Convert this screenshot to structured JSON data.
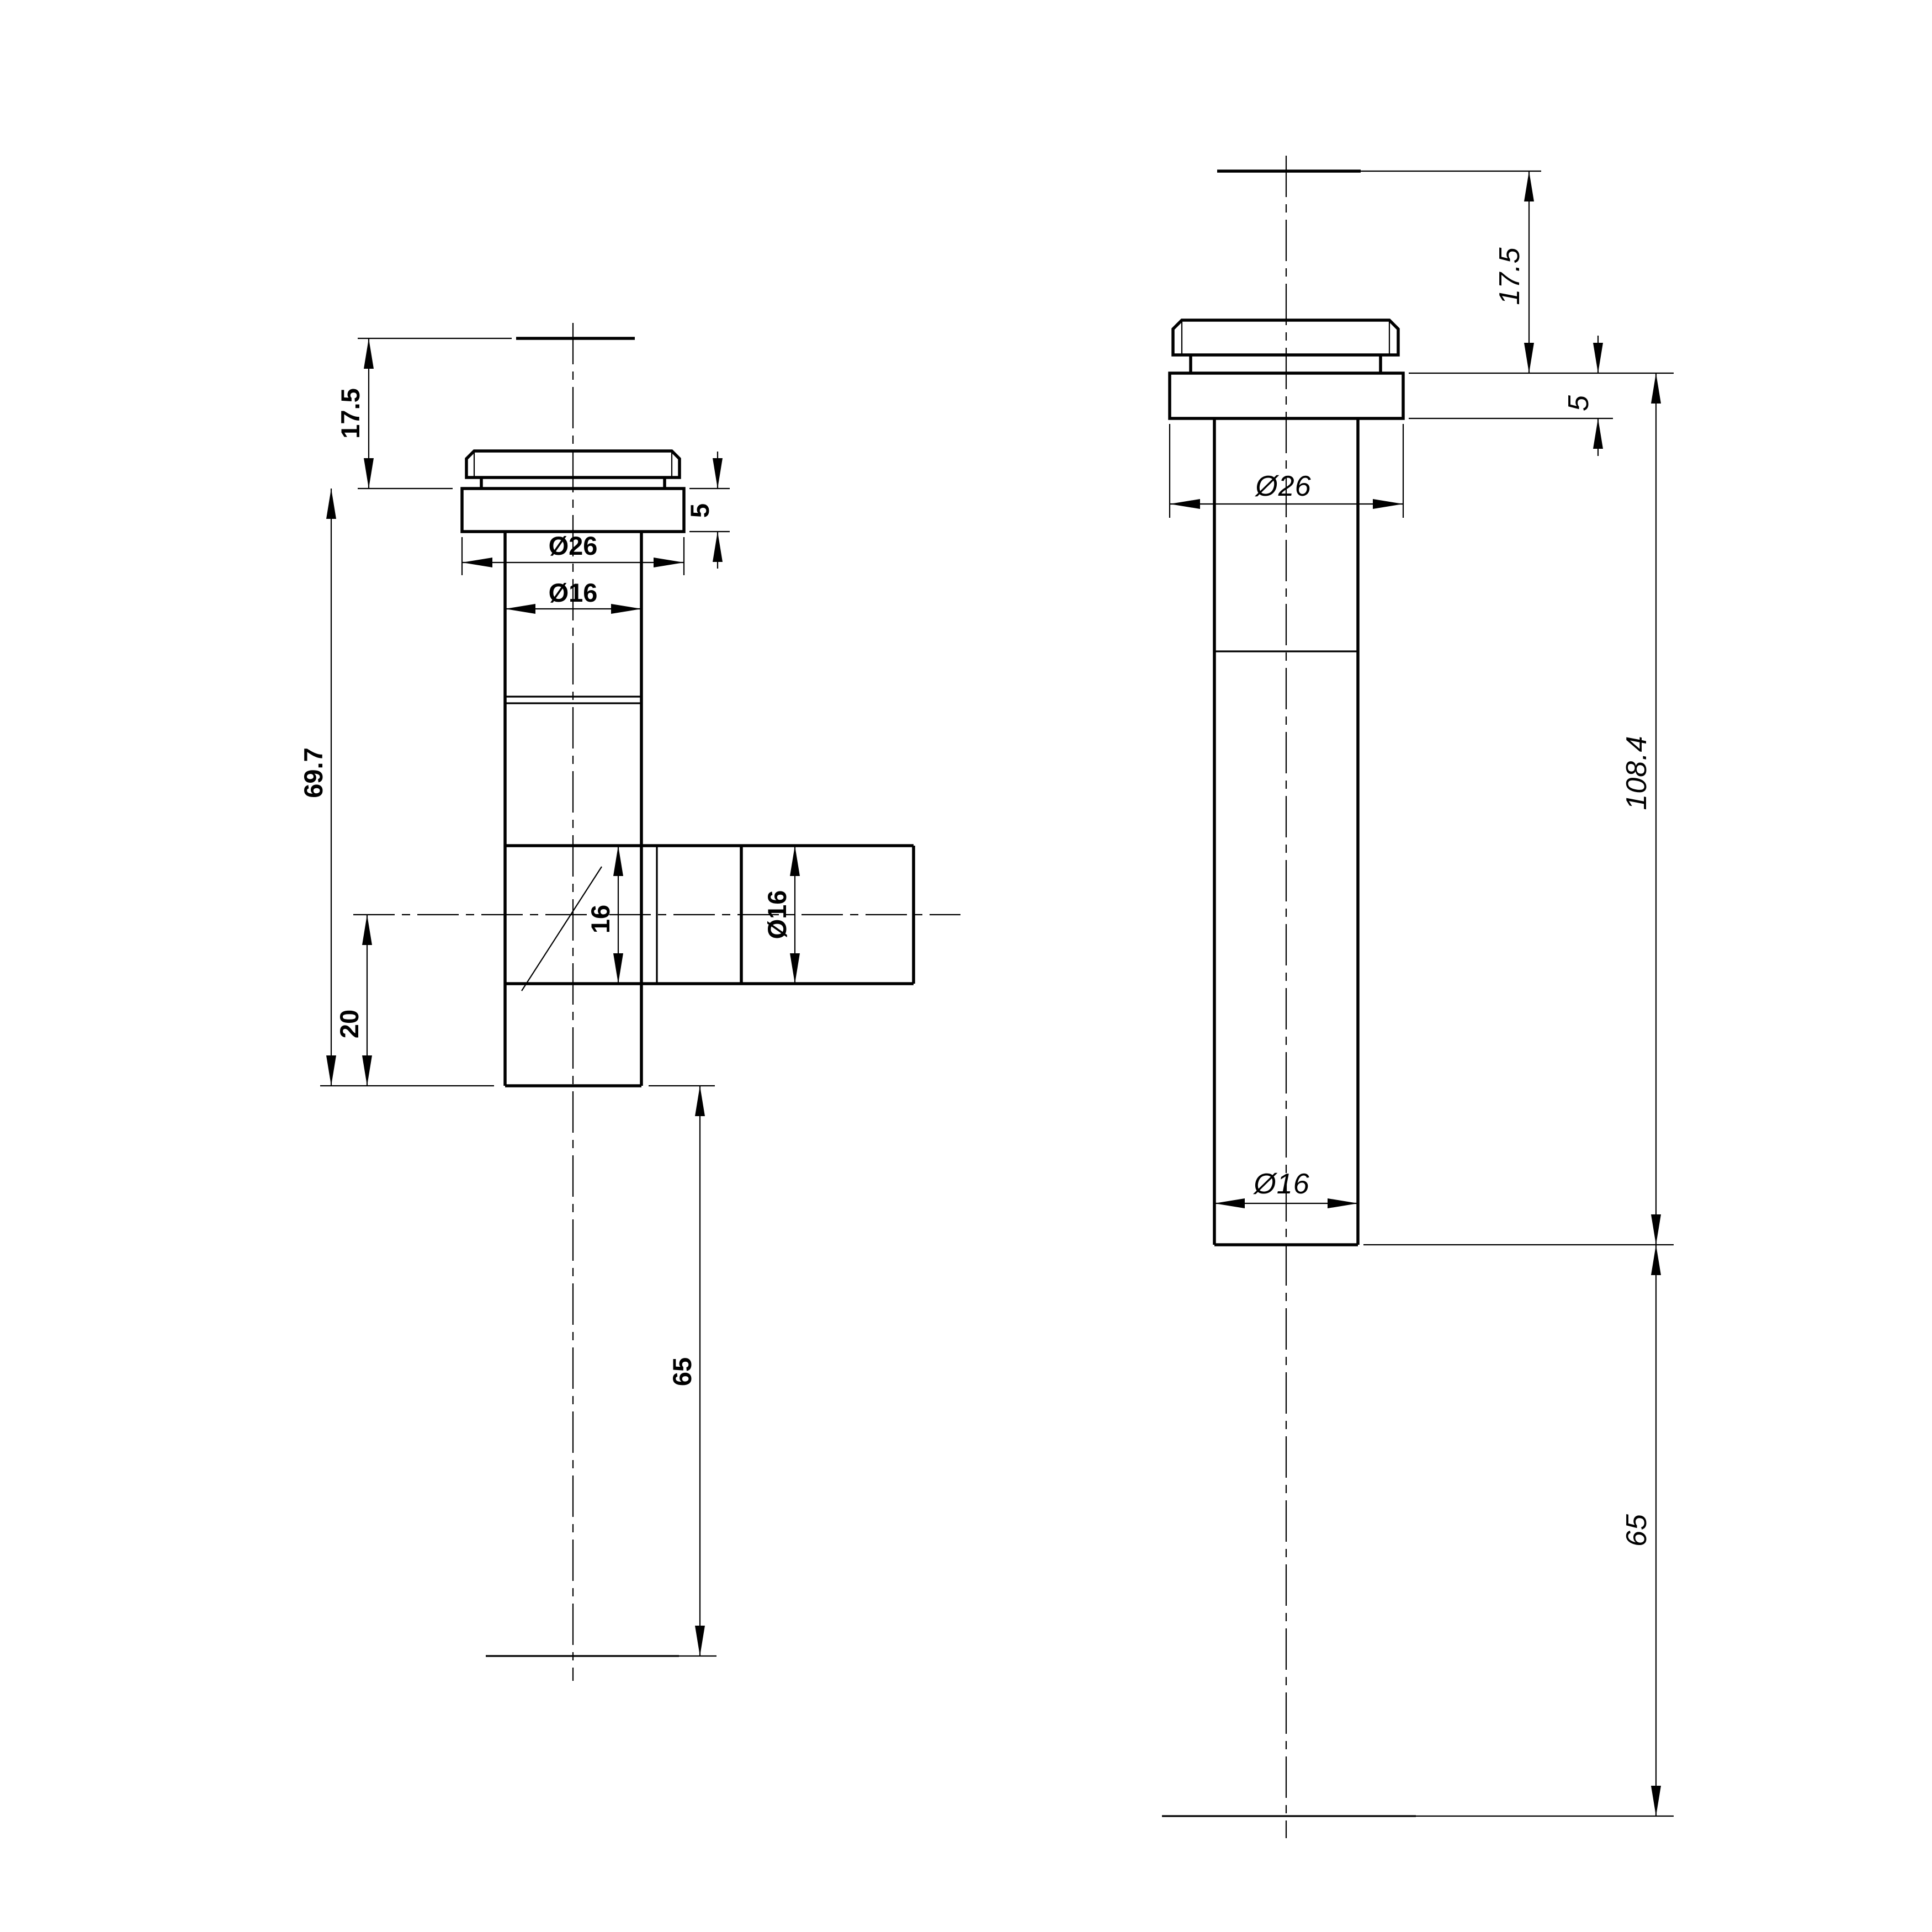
{
  "drawing": {
    "type": "cad-dimension-drawing",
    "background": "#ffffff",
    "ink": "#000000",
    "views": [
      {
        "name": "tee-fitting-side-view",
        "dims": {
          "cap_height": "17.5",
          "flange_height": "5",
          "flange_diameter": "Ø26",
          "pipe_diameter": "Ø16",
          "body_length": "69.7",
          "branch_axis_to_end": "20",
          "branch_bore": "16",
          "branch_diameter": "Ø16",
          "tail_extension": "65"
        }
      },
      {
        "name": "straight-tube-side-view",
        "dims": {
          "cap_height": "17.5",
          "flange_height": "5",
          "flange_diameter": "Ø26",
          "body_length": "108.4",
          "pipe_diameter": "Ø16",
          "tail_extension": "65"
        }
      }
    ]
  }
}
